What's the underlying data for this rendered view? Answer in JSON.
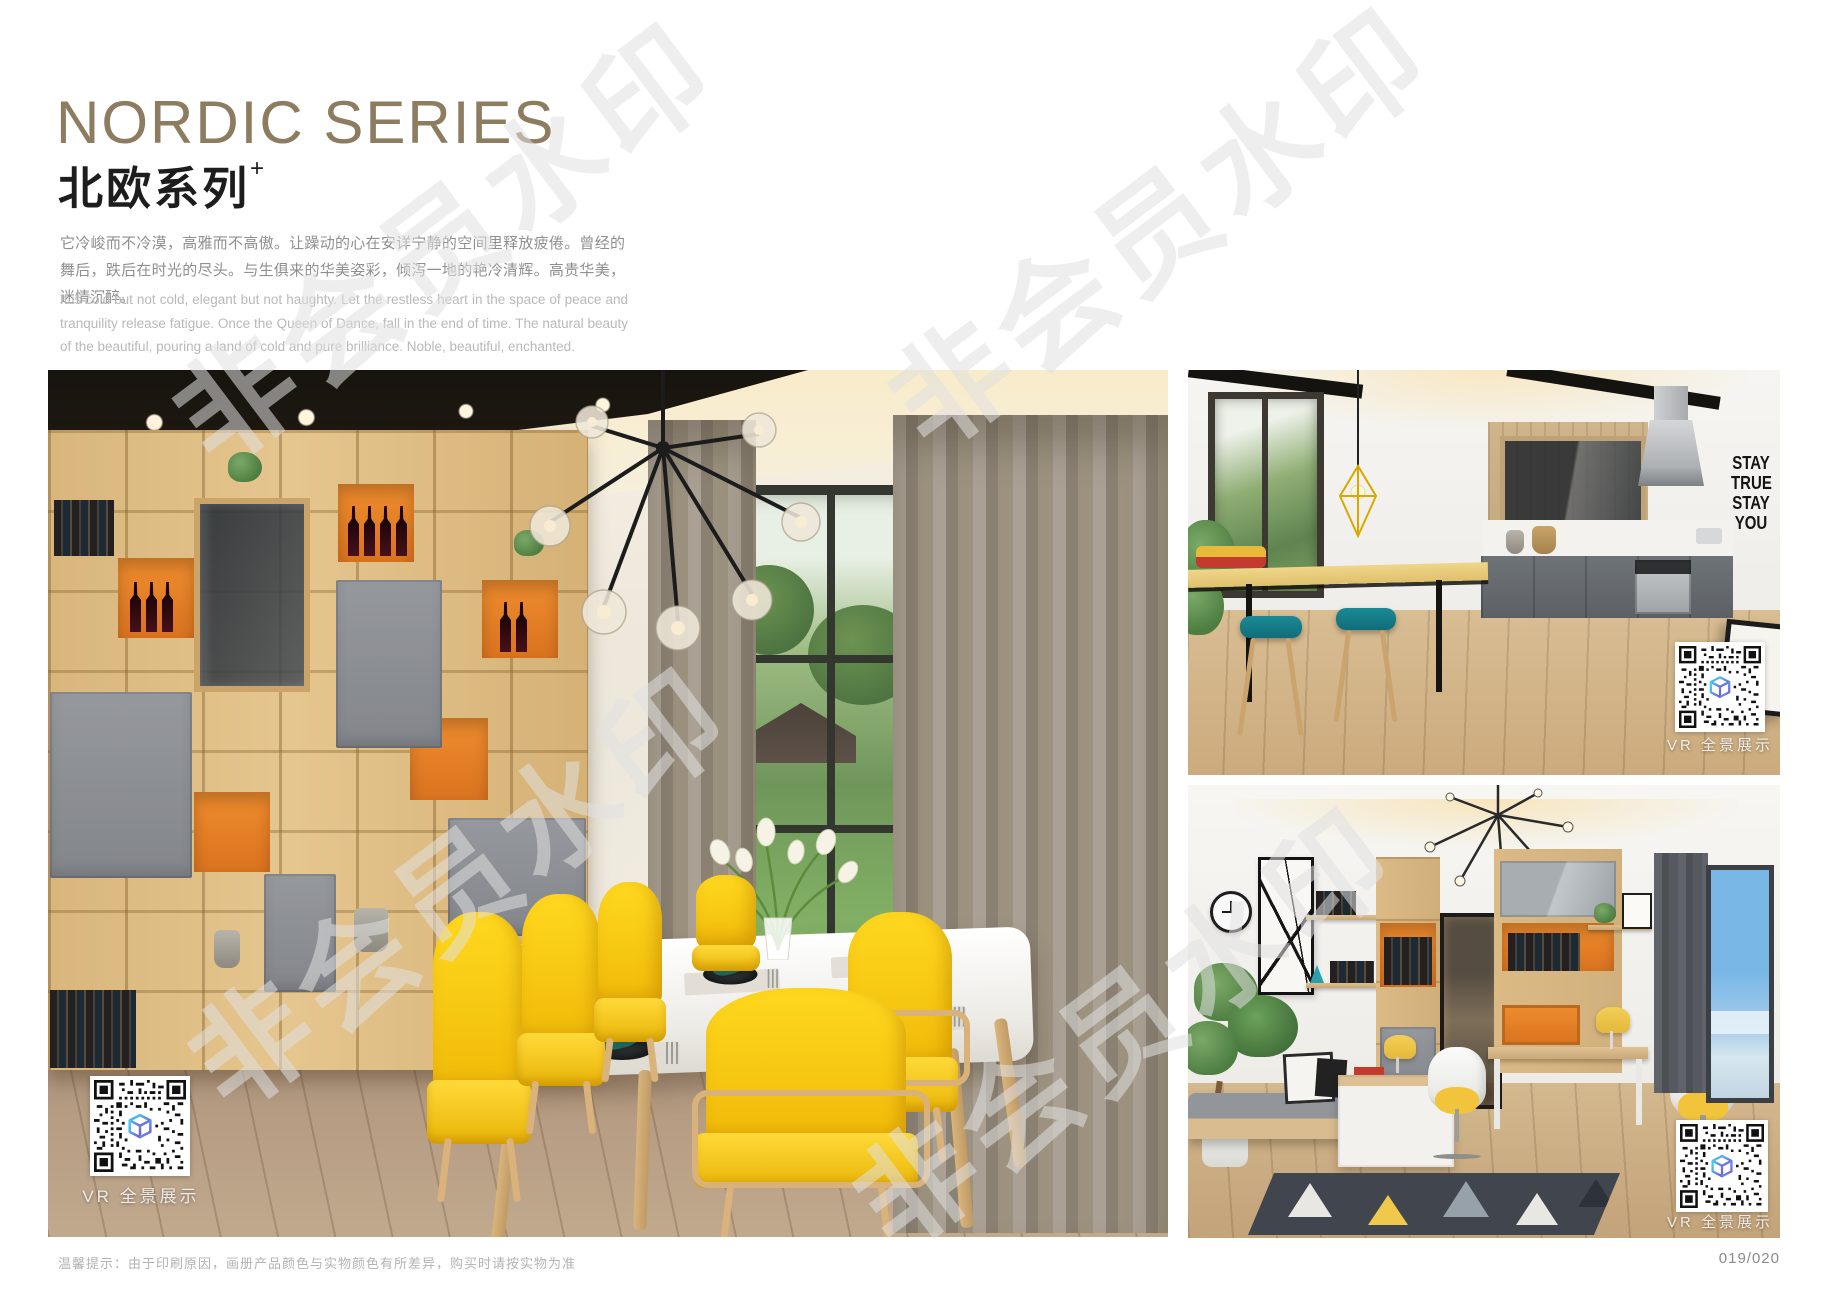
{
  "page": {
    "header": {
      "title": "NORDIC SERIES",
      "subtitle_cn": "北欧系列",
      "subtitle_mark": "+",
      "desc_cn": "它冷峻而不冷漠，高雅而不高傲。让躁动的心在安详宁静的空间里释放疲倦。曾经的舞后，跌后在时光的尽头。与生俱来的华美姿彩，倾泻一地的艳冷清辉。高贵华美，迷情沉醉。",
      "desc_en": "It is cold but not cold, elegant but not haughty. Let the restless heart in the space of peace and tranquility release fatigue. Once the Queen of Dance, fall in the end of time. The natural beauty of the beautiful, pouring a land of cold and pure brilliance. Noble, beautiful, enchanted."
    },
    "watermark": {
      "text": "非会员水印"
    },
    "photos": {
      "dining": {
        "vr_label": "VR 全景展示"
      },
      "kitchen": {
        "vr_label": "VR 全景展示",
        "wall_art": [
          "STAY",
          "TRUE",
          "STAY",
          "YOU"
        ]
      },
      "study": {
        "vr_label": "VR 全景展示"
      }
    },
    "footer": {
      "note": "温馨提示：由于印刷原因，画册产品颜色与实物颜色有所差异，购买时请按实物为准",
      "page_no": "019/020"
    },
    "colors": {
      "accent_title": "#8d7c60",
      "shelf_orange": "#e07b26",
      "chair_yellow": "#f7c911",
      "napkin_teal": "#1e5f5b",
      "stool_teal": "#15808d",
      "qr_cube_cyan": "#3fd8f0",
      "qr_cube_purple": "#7b52d8"
    }
  }
}
